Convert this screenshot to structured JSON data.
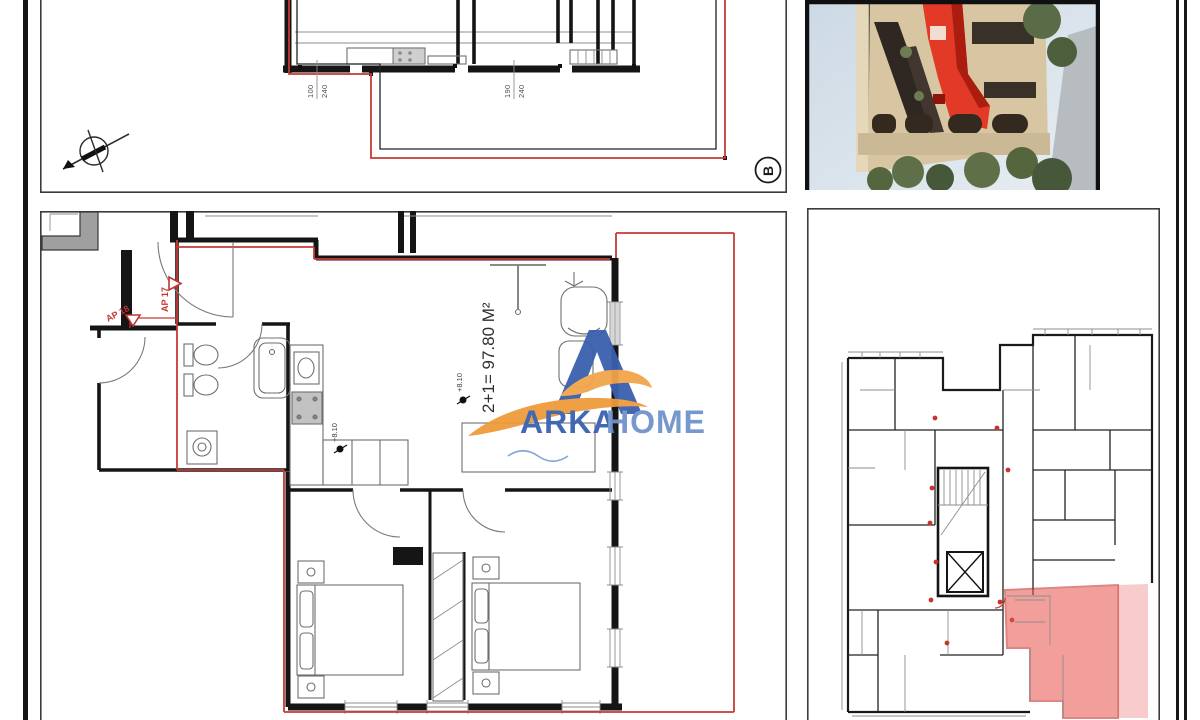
{
  "document": {
    "area_label": "2+1= 97.80 M²",
    "section_label": "B",
    "apartment_marker_1": "AP 17",
    "apartment_marker_2": "AP 18",
    "elevation_marker_1": "+8.10",
    "elevation_marker_2": "+8.10",
    "door_dimension_1": {
      "width": "100",
      "height": "240"
    },
    "door_dimension_2": {
      "width": "190",
      "height": "240"
    }
  },
  "branding": {
    "name_left": "ARKA",
    "name_right": "HOME",
    "blue": "#3a62b0",
    "light_blue": "#7093cb",
    "orange": "#ef9a3b"
  },
  "colors": {
    "plan_boundary_red": "#c63a35",
    "apartment_highlight_red": "#e8524d",
    "render_highlight_red": "#e23a26",
    "wall_black": "#151515"
  }
}
